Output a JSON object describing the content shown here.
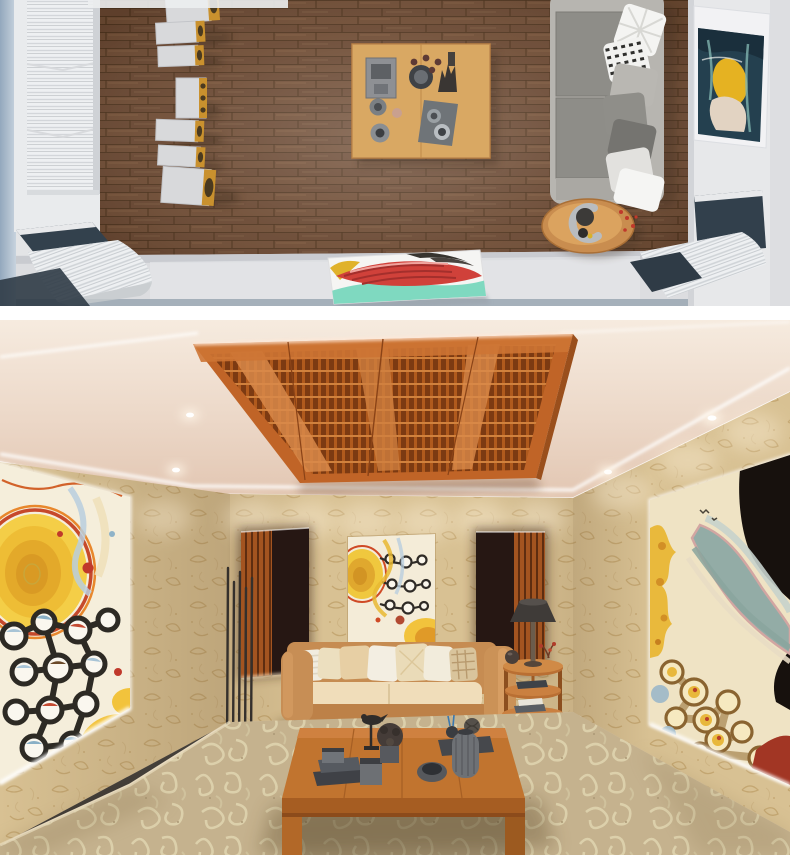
{
  "meta": {
    "title": "Hi-fi listening room interior — 3D render collage",
    "width_px": 790,
    "height_px": 855
  },
  "scenes": {
    "top_view": {
      "label": "Top-down render: wood-floor listening room with speaker column, coffee table, gray sofa, wall art and acoustic diffusers"
    },
    "perspective": {
      "label": "Perspective render: beige listening lounge with ceiling wood diffuser, LED coves, abstract wall paintings, leather sofa and coffee table"
    }
  },
  "palette": {
    "floor_wood": "#6e4b33",
    "side_strip": "#a9bccd",
    "diffuser_white": "#eef0f2",
    "speaker_body": "#d8d9db",
    "speaker_gold": "#c9912e",
    "sofa_frame": "#b7b5b0",
    "sofa_cushion": "#8e8d88",
    "table_wood_top": "#d7a258",
    "navy_panel": "#33414d",
    "bottom_wall": "#dcdde0",
    "right_wall": "#e7e8ea",
    "canvas_red": "#d0413a",
    "canvas_teal": "#7fd9c0",
    "painting_navy": "#24404f",
    "painting_yellow": "#e5b222",
    "ceiling_hi": "#f6ebdf",
    "ceiling_lo": "#e2c6b2",
    "led_white": "#ffffff",
    "diffuser_orange": "#c06427",
    "diffuser_dark": "#7c3a12",
    "diffuser_light": "#e09254",
    "wallpaper_base": "#d8c193",
    "alcove_dark": "#261713",
    "alcove_slat": "#a35420",
    "art_cream": "#f5eedb",
    "art_yellow": "#f0c440",
    "art_outline_red": "#c6492b",
    "chain_black": "#2d2a24",
    "river_bluegray": "#93aca6",
    "black_patch": "#17110d",
    "red_patch": "#a23624",
    "sofa_leather": "#c68c52",
    "cushion_cream": "#f0ddba",
    "coffee_table_wood": "#bb6c2d",
    "decor_gray": "#54565a",
    "carpet_base": "#c2ae88",
    "carpet_swirl": "#ded2ab",
    "lamp_shade": "#3f3b38"
  }
}
